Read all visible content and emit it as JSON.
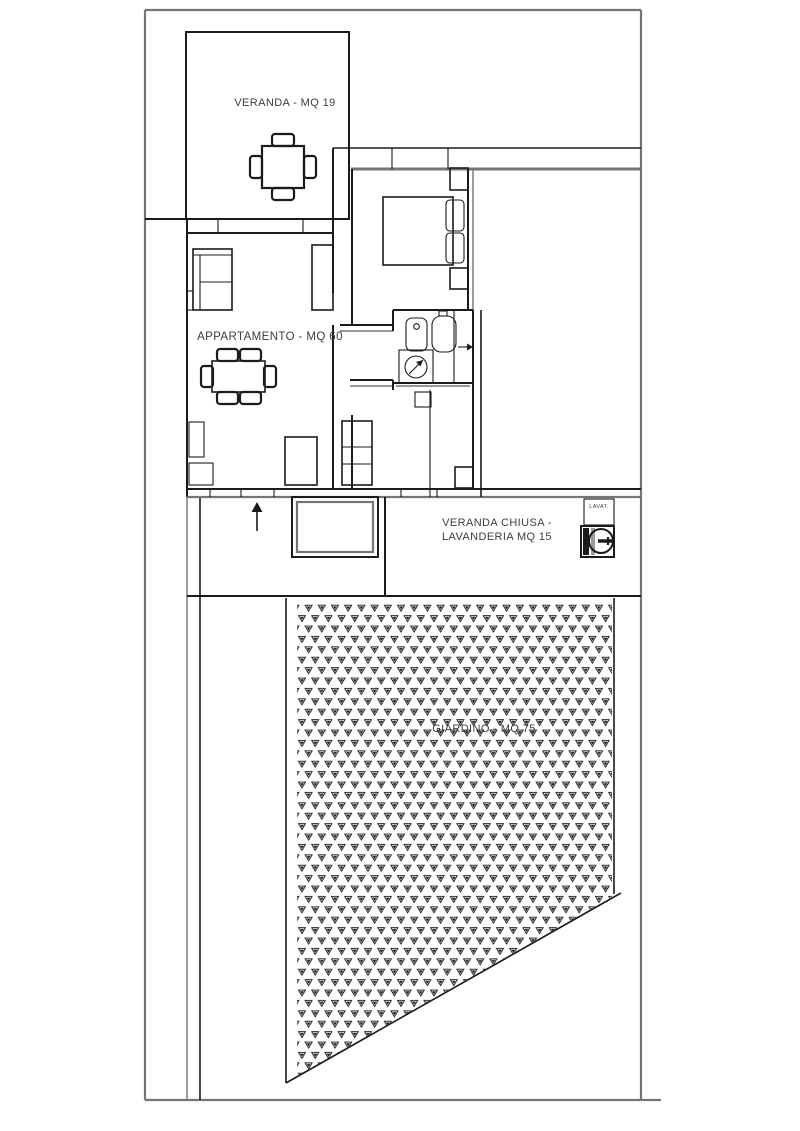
{
  "document": {
    "type": "architectural floor plan"
  },
  "plan": {
    "rooms": [
      {
        "id": "veranda",
        "label": "VERANDA - MQ 19",
        "area_mq": 19
      },
      {
        "id": "appartamento",
        "label": "APPARTAMENTO - MQ 60",
        "area_mq": 60
      },
      {
        "id": "veranda-chiusa",
        "label_line1": "VERANDA CHIUSA -",
        "label_line2": "LAVANDERIA MQ 15",
        "area_mq": 15
      },
      {
        "id": "giardino",
        "label": "GIARDINO - MQ 75",
        "area_mq": 75
      }
    ],
    "fixtures": [
      {
        "id": "lavatrice-cabinet",
        "label": "LAVAT."
      }
    ],
    "colors": {
      "wall": "#1b1b1b",
      "outer": "#757575",
      "text": "#3d3d3d",
      "bg": "#ffffff"
    }
  }
}
